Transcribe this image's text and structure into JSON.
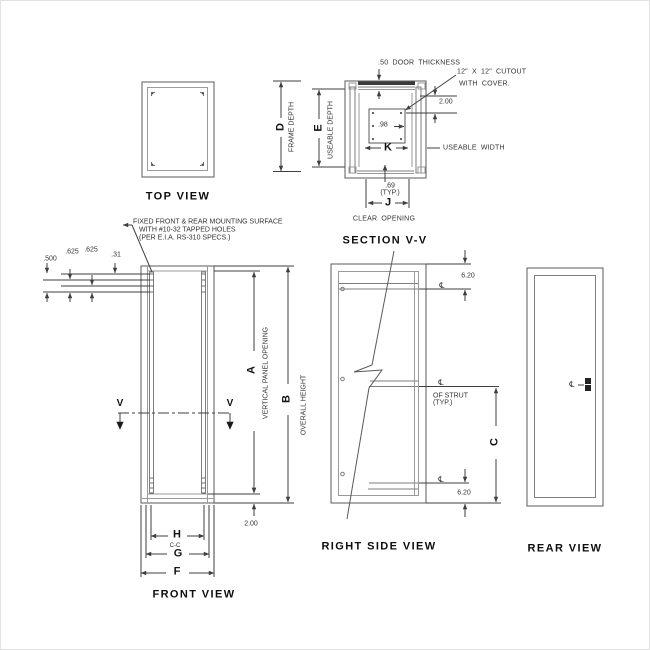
{
  "palette": {
    "line": "#5a5a5a",
    "light_line": "#9a9a9a",
    "dim_line": "#3f3f3f",
    "text": "#333333",
    "title_text": "#0e0e0e",
    "background": "#ffffff"
  },
  "views": {
    "top_view": {
      "title": "TOP VIEW"
    },
    "depth_dims": {
      "d": "D",
      "frame_depth": "FRAME DEPTH",
      "e": "E",
      "useable_depth": "USEABLE DEPTH"
    },
    "section_vv": {
      "title": "SECTION V-V",
      "door_thickness": ".50 DOOR THICKNESS",
      "cutout_line1": "12\" X 12\" CUTOUT",
      "cutout_line2": "WITH COVER.",
      "dim_door_to_cutout": "2.00",
      "dim_hole_offset": ".98",
      "dim_k": "K",
      "useable_width": "USEABLE WIDTH",
      "dim_rail_offset": ".69",
      "rail_offset_typ": "(TYP.)",
      "dim_j": "J",
      "clear_opening": "CLEAR OPENING"
    },
    "front_view": {
      "title": "FRONT VIEW",
      "note_line1": "FIXED FRONT & REAR MOUNTING SURFACE",
      "note_line2": "WITH #10-32 TAPPED HOLES",
      "note_line3": "(PER E.I.A. RS-310 SPECS.)",
      "dim_hole_spacing_1": ".500",
      "dim_hole_spacing_2": ".625",
      "dim_hole_spacing_3": ".625",
      "dim_hole_spacing_4": ".31",
      "dim_a": "A",
      "vertical_panel_opening": "VERTICAL PANEL OPENING",
      "dim_b": "B",
      "overall_height": "OVERALL HEIGHT",
      "dim_bottom_offset": "2.00",
      "dim_h": "H",
      "center_to_center": "C-C",
      "dim_g": "G",
      "dim_f": "F",
      "section_arrow_left": "V",
      "section_arrow_right": "V"
    },
    "right_side_view": {
      "title": "RIGHT SIDE VIEW",
      "dim_strut_top": "6.20",
      "dim_strut_bottom": "6.20",
      "centerline_top": "℄",
      "centerline_mid": "℄",
      "centerline_bottom": "℄",
      "of_strut": "OF STRUT",
      "of_strut_typ": "(TYP.)",
      "dim_c": "C"
    },
    "rear_view": {
      "title": "REAR VIEW",
      "centerline_handle": "℄"
    }
  }
}
